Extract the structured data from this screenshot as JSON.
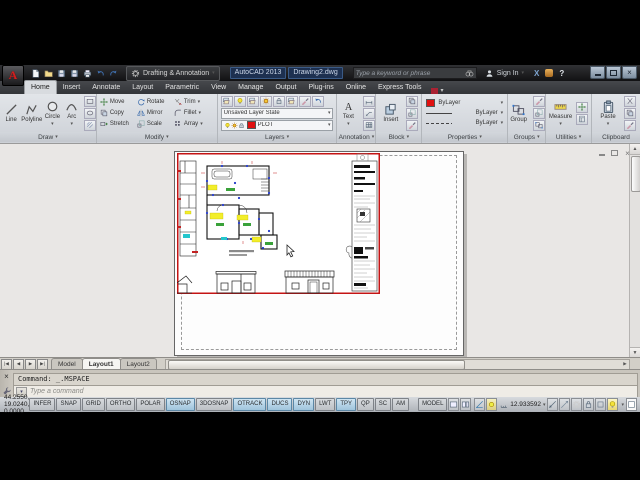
{
  "titlebar": {
    "workspace": "Drafting & Annotation",
    "app_title": "AutoCAD 2013",
    "doc_title": "Drawing2.dwg",
    "search_placeholder": "Type a keyword or phrase",
    "sign_in_label": "Sign In"
  },
  "ribbon": {
    "tabs": [
      "Home",
      "Insert",
      "Annotate",
      "Layout",
      "Parametric",
      "View",
      "Manage",
      "Output",
      "Plug-ins",
      "Online",
      "Express Tools"
    ],
    "active_tab": "Home",
    "draw": {
      "label": "Draw",
      "line": "Line",
      "polyline": "Polyline",
      "circle": "Circle",
      "arc": "Arc"
    },
    "modify": {
      "label": "Modify",
      "move": "Move",
      "copy": "Copy",
      "stretch": "Stretch",
      "rotate": "Rotate",
      "mirror": "Mirror",
      "scale": "Scale",
      "trim": "Trim",
      "fillet": "Fillet",
      "array": "Array"
    },
    "layers": {
      "label": "Layers",
      "state": "Unsaved Layer State",
      "current": "PLOT",
      "current_color": "#e01010"
    },
    "annotation": {
      "label": "Annotation",
      "text": "Text"
    },
    "block": {
      "label": "Block",
      "insert": "Insert"
    },
    "properties": {
      "label": "Properties",
      "color": "ByLayer",
      "linetype": "ByLayer",
      "lineweight": "ByLayer"
    },
    "groups": {
      "label": "Groups",
      "group": "Group"
    },
    "utilities": {
      "label": "Utilities",
      "measure": "Measure"
    },
    "clipboard": {
      "label": "Clipboard",
      "paste": "Paste"
    }
  },
  "layout_tabs": {
    "model": "Model",
    "layout1": "Layout1",
    "layout2": "Layout2",
    "active": "Layout1"
  },
  "command_line": {
    "history": "Command: _.MSPACE",
    "placeholder": "Type a command"
  },
  "status_bar": {
    "coordinates": "44.2550, 19.0240, 0.0000",
    "toggles": [
      {
        "label": "INFER",
        "on": false
      },
      {
        "label": "SNAP",
        "on": false
      },
      {
        "label": "GRID",
        "on": false
      },
      {
        "label": "ORTHO",
        "on": false
      },
      {
        "label": "POLAR",
        "on": false
      },
      {
        "label": "OSNAP",
        "on": true
      },
      {
        "label": "3DOSNAP",
        "on": false
      },
      {
        "label": "OTRACK",
        "on": true
      },
      {
        "label": "DUCS",
        "on": true
      },
      {
        "label": "DYN",
        "on": true
      },
      {
        "label": "LWT",
        "on": false
      },
      {
        "label": "TPY",
        "on": true
      },
      {
        "label": "QP",
        "on": false
      },
      {
        "label": "SC",
        "on": false
      },
      {
        "label": "AM",
        "on": false
      }
    ],
    "model_button": "MODEL",
    "viewport_scale": "12.933592"
  },
  "colors": {
    "viewport_border": "#c41414",
    "plot_layer_swatch": "#e01010",
    "highlight_yellow": "#f2ee2a",
    "device_blue": "#2238c8",
    "status_on_blue": "#9fc4dc"
  }
}
